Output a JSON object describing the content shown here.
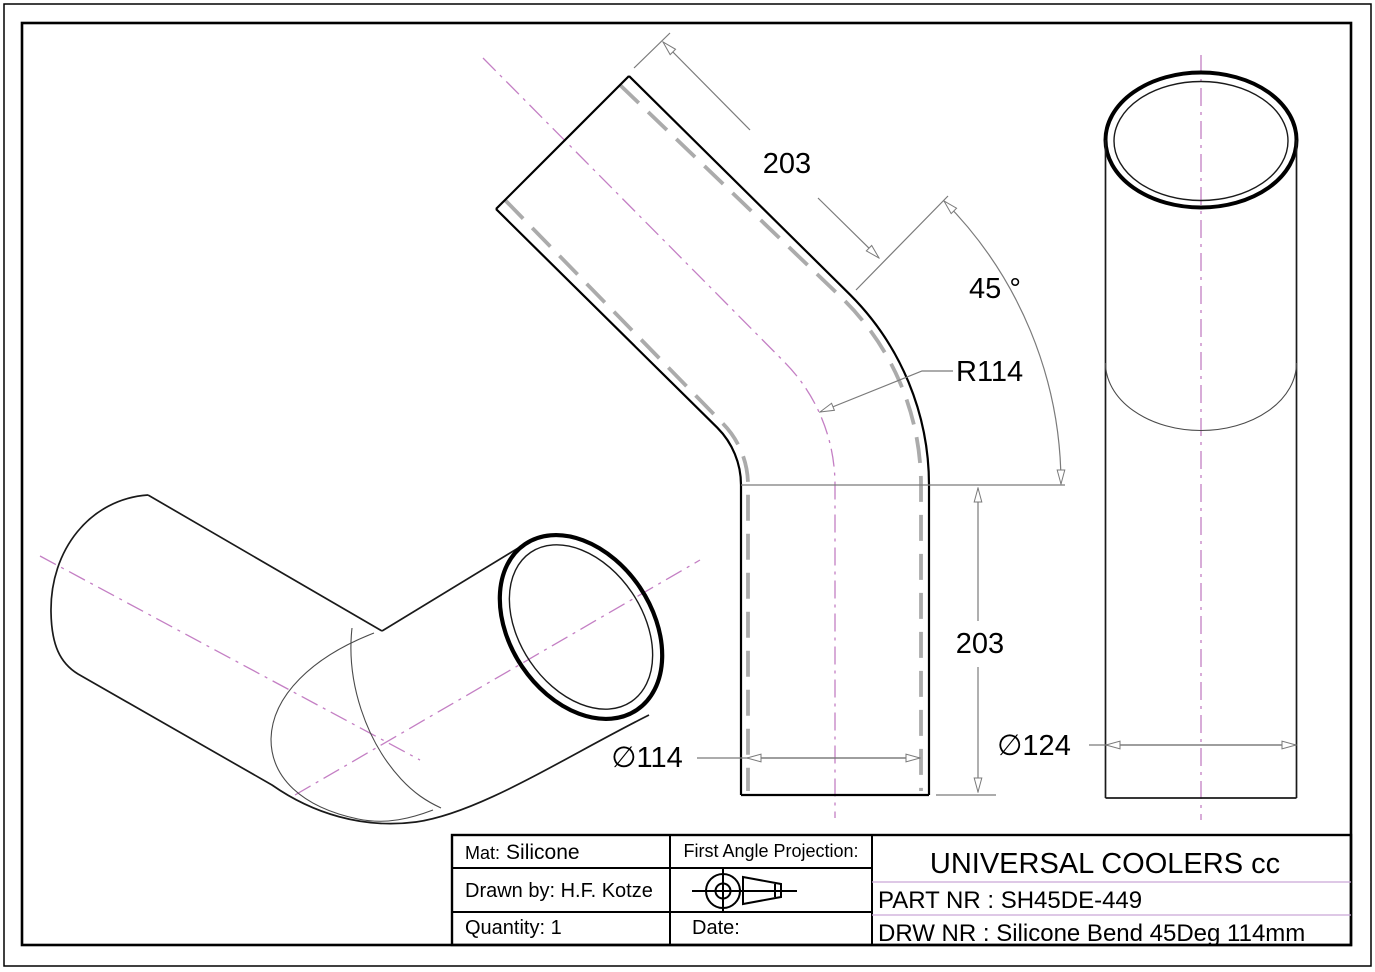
{
  "dimensions": {
    "diagonal_length": "203",
    "vertical_length": "203",
    "bend_angle": "45 °",
    "bend_radius": "R114",
    "inner_diameter": "∅114",
    "outer_diameter": "∅124"
  },
  "title_block": {
    "material_label": "Mat:",
    "material_value": "Silicone",
    "drawn_by": "Drawn by: H.F. Kotze",
    "quantity": "Quantity: 1",
    "projection_label": "First Angle Projection:",
    "date_label": "Date:",
    "company": "UNIVERSAL COOLERS cc",
    "part_nr": "PART NR : SH45DE-449",
    "drw_nr": "DRW NR : Silicone Bend 45Deg 114mm"
  },
  "colors": {
    "outline": "#000000",
    "hidden_line": "#ababab",
    "centerline": "#c47fc4",
    "dimension_line": "#7a7a7a",
    "title_divider": "#c9a8d8"
  }
}
